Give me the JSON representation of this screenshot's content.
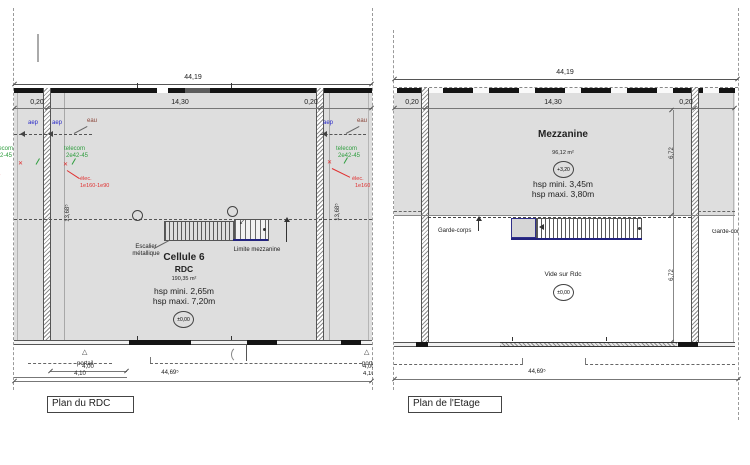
{
  "drawing": {
    "colors": {
      "plan_fill": "#dedede",
      "wall": "#141414",
      "stair_stringer": "#23237e",
      "aep_blue": "#2929c8",
      "eau_maroon": "#8a4438",
      "telecom_green": "#2f9e3f",
      "elec_red": "#e02f2f"
    },
    "rdc": {
      "title": "Plan du RDC",
      "dims": {
        "total_top": "44,19",
        "wall_left": "0,20",
        "bay": "14,30",
        "wall_right": "0,20",
        "depth_left": "13,68⁵",
        "depth_right": "13,68⁵",
        "gate_w1": "4,00",
        "gate_w2": "4,10",
        "total_bottom": "44,69⁵"
      },
      "room": {
        "name": "Cellule 6",
        "level": "RDC",
        "area": "190,35 m²",
        "hsp_min": "hsp mini. 2,65m",
        "hsp_max": "hsp maxi. 7,20m",
        "level_mark": "±0,00"
      },
      "labels": {
        "stair_1": "Escalier",
        "stair_2": "métallique",
        "mezz_limit": "Limite mezzanine",
        "gate": "portail"
      },
      "utilities": {
        "aep": "aep",
        "eau": "eau",
        "telecom_1": "telecom",
        "telecom_2": "2e42-45",
        "elec": "élec.",
        "elec_left_ref": "1e160-1e90",
        "elec_right_ref": "1e160"
      }
    },
    "etage": {
      "title": "Plan de l'Etage",
      "dims": {
        "total_top": "44,19",
        "wall_left": "0,20",
        "bay": "14,30",
        "wall_right": "0,20",
        "mezz_depth": "6,72",
        "void_depth": "6,72",
        "total_bottom": "44,69⁵"
      },
      "room": {
        "name": "Mezzanine",
        "area": "96,12 m²",
        "level_mark": "+3,20",
        "hsp_min": "hsp mini. 3,45m",
        "hsp_max": "hsp maxi. 3,80m"
      },
      "labels": {
        "void": "Vide sur Rdc",
        "void_level": "±0,00",
        "guardrail": "Garde-corps"
      }
    }
  }
}
